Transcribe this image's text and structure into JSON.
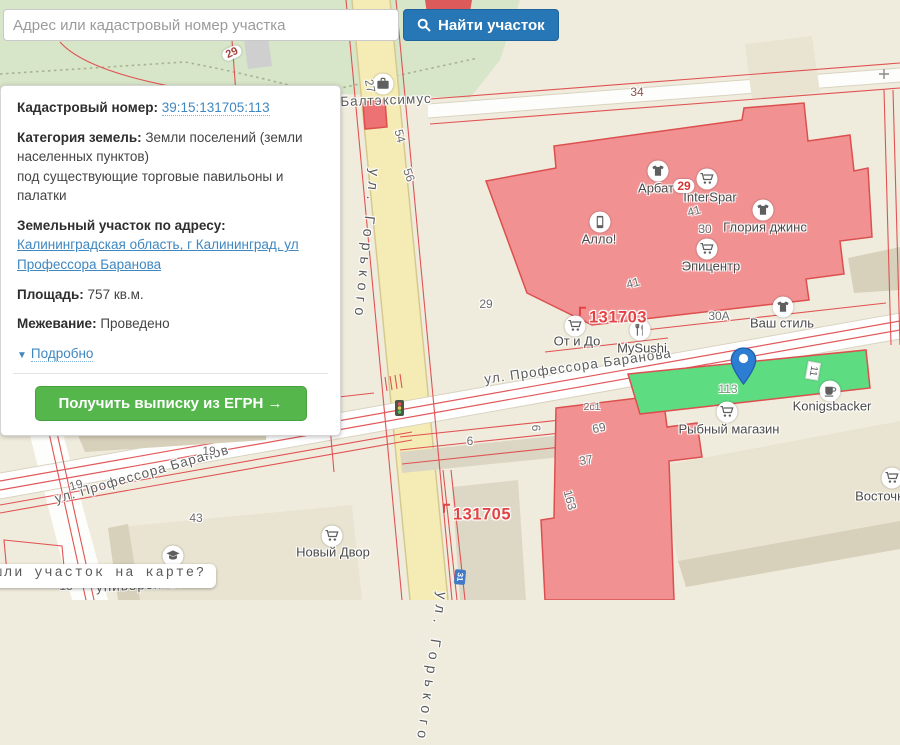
{
  "search": {
    "placeholder": "Адрес или кадастровый номер участка",
    "button_label": "Найти участок"
  },
  "panel": {
    "cadastral_label": "Кадастровый номер:",
    "cadastral_value": "39:15:131705:113",
    "category_label": "Категория земель:",
    "category_value": "Земли поселений (земли населенных пунктов)",
    "category_note": "под существующие торговые павильоны и палатки",
    "address_label": "Земельный участок по адресу:",
    "address_value": "Калининградская область, г Калининград, ул Профессора Баранова",
    "area_label": "Площадь:",
    "area_value": "757 кв.м.",
    "survey_label": "Межевание:",
    "survey_value": "Проведено",
    "details_link": "Подробно",
    "egrn_button": "Получить выписку из ЕГРН →"
  },
  "tooltip": {
    "text": "шли участок на карте?"
  },
  "colors": {
    "accent_blue": "#2776b5",
    "accent_green": "#55b64c",
    "link_blue": "#3f87c0",
    "cadastral_red": "#e05353",
    "overlay_pink": "#f19192",
    "selected_parcel_green": "#5edc82",
    "road_yellow": "#f5ecb5",
    "land_beige": "#f0ecdd",
    "green_zone": "#d7e5c8"
  },
  "map": {
    "streets": [
      {
        "t": "ул. Горького",
        "x": 366,
        "y": 245,
        "r": 6,
        "v": 1
      },
      {
        "t": "ул. Горького",
        "x": 431,
        "y": 668,
        "r": 8,
        "v": 1
      },
      {
        "t": "ул. Профессора Баранова",
        "x": 578,
        "y": 366,
        "r": -8
      },
      {
        "t": "ул. Профессора Баранов",
        "x": 142,
        "y": 474,
        "r": -16
      },
      {
        "t": "ский",
        "x": 6,
        "y": 400,
        "r": -12
      },
      {
        "t": "университет",
        "x": 140,
        "y": 585,
        "r": -3
      },
      {
        "t": "Балтэксимус",
        "x": 386,
        "y": 100,
        "r": -2
      }
    ],
    "pois": [
      {
        "icon": "briefcase-icon",
        "ix": 383,
        "iy": 84
      },
      {
        "icon": "tshirt-icon",
        "ix": 658,
        "iy": 171,
        "label": "Арбат",
        "lx": 656,
        "ly": 188
      },
      {
        "icon": "cart-icon",
        "ix": 707,
        "iy": 179,
        "label": "InterSpar",
        "lx": 710,
        "ly": 197
      },
      {
        "icon": "tshirt-icon",
        "ix": 763,
        "iy": 210,
        "label": "Глория джинс",
        "lx": 765,
        "ly": 227
      },
      {
        "icon": "phone-icon",
        "ix": 600,
        "iy": 222,
        "label": "Алло!",
        "lx": 599,
        "ly": 239
      },
      {
        "icon": "cart-icon",
        "ix": 707,
        "iy": 249,
        "label": "Эпицентр",
        "lx": 711,
        "ly": 266
      },
      {
        "icon": "cart-icon",
        "ix": 575,
        "iy": 326,
        "label": "От и До",
        "lx": 577,
        "ly": 341
      },
      {
        "icon": "utensils-icon",
        "ix": 640,
        "iy": 330,
        "label": "MySushi",
        "lx": 642,
        "ly": 348
      },
      {
        "icon": "tshirt-icon",
        "ix": 783,
        "iy": 307,
        "label": "Ваш стиль",
        "lx": 782,
        "ly": 323
      },
      {
        "icon": "cup-icon",
        "ix": 830,
        "iy": 391,
        "label": "Konigsbacker",
        "lx": 832,
        "ly": 406
      },
      {
        "icon": "cart-icon",
        "ix": 727,
        "iy": 412,
        "label": "Рыбный магазин",
        "lx": 729,
        "ly": 429
      },
      {
        "icon": "cart-icon",
        "ix": 332,
        "iy": 536,
        "label": "Новый Двор",
        "lx": 333,
        "ly": 552
      },
      {
        "icon": "cart-icon",
        "ix": 892,
        "iy": 478,
        "label": "Восточный",
        "lx": 888,
        "ly": 496
      },
      {
        "icon": "utensils-icon",
        "ix": 321,
        "iy": 372,
        "label": "Кано",
        "lx": 319,
        "ly": 389
      },
      {
        "icon": "briefcase-icon",
        "ix": 208,
        "iy": 357,
        "label": "Акрополь",
        "lx": 208,
        "ly": 375
      },
      {
        "icon": "grad-cap-icon",
        "ix": 173,
        "iy": 556
      }
    ],
    "quarter_numbers": [
      {
        "t": "131703",
        "x": 613,
        "y": 317
      },
      {
        "t": "131705",
        "x": 477,
        "y": 514
      },
      {
        "t": "121801",
        "x": 241,
        "y": 356
      }
    ],
    "parcel_numbers": [
      {
        "t": "34",
        "x": 637,
        "y": 92,
        "cls": "num-brown"
      },
      {
        "t": "27",
        "x": 370,
        "y": 86,
        "r": 78
      },
      {
        "t": "54",
        "x": 400,
        "y": 136,
        "r": 75
      },
      {
        "t": "56",
        "x": 409,
        "y": 175,
        "r": 70
      },
      {
        "t": "29",
        "x": 232,
        "y": 53,
        "r": -25,
        "cls": "pill"
      },
      {
        "t": "34",
        "x": 74,
        "y": 351,
        "r": -15,
        "cls": "pill"
      },
      {
        "t": "29",
        "x": 684,
        "y": 186,
        "cls": "pill pill-red"
      },
      {
        "t": "41",
        "x": 694,
        "y": 211,
        "r": -15
      },
      {
        "t": "30",
        "x": 705,
        "y": 229
      },
      {
        "t": "41",
        "x": 633,
        "y": 283,
        "r": -15
      },
      {
        "t": "29",
        "x": 486,
        "y": 304
      },
      {
        "t": "30А",
        "x": 719,
        "y": 316
      },
      {
        "t": "2с1",
        "x": 592,
        "y": 407,
        "cls": "num-sm"
      },
      {
        "t": "6",
        "x": 470,
        "y": 441
      },
      {
        "t": "6",
        "x": 536,
        "y": 428,
        "r": 90
      },
      {
        "t": "69",
        "x": 599,
        "y": 428,
        "r": -12
      },
      {
        "t": "37",
        "x": 586,
        "y": 460,
        "r": -10
      },
      {
        "t": "163",
        "x": 570,
        "y": 500,
        "r": 75
      },
      {
        "t": "113",
        "x": 728,
        "y": 389,
        "cls": "num-green"
      },
      {
        "t": "11",
        "x": 813,
        "y": 371,
        "r": 100,
        "cls": "plate"
      },
      {
        "t": "19",
        "x": 76,
        "y": 485,
        "r": -16
      },
      {
        "t": "19",
        "x": 209,
        "y": 451
      },
      {
        "t": "43",
        "x": 196,
        "y": 518
      },
      {
        "t": "13",
        "x": 66,
        "y": 586
      },
      {
        "t": "й",
        "x": 200,
        "y": 570
      },
      {
        "t": "31",
        "x": 460,
        "y": 577,
        "r": 95,
        "cls": "badge-blue"
      }
    ]
  }
}
